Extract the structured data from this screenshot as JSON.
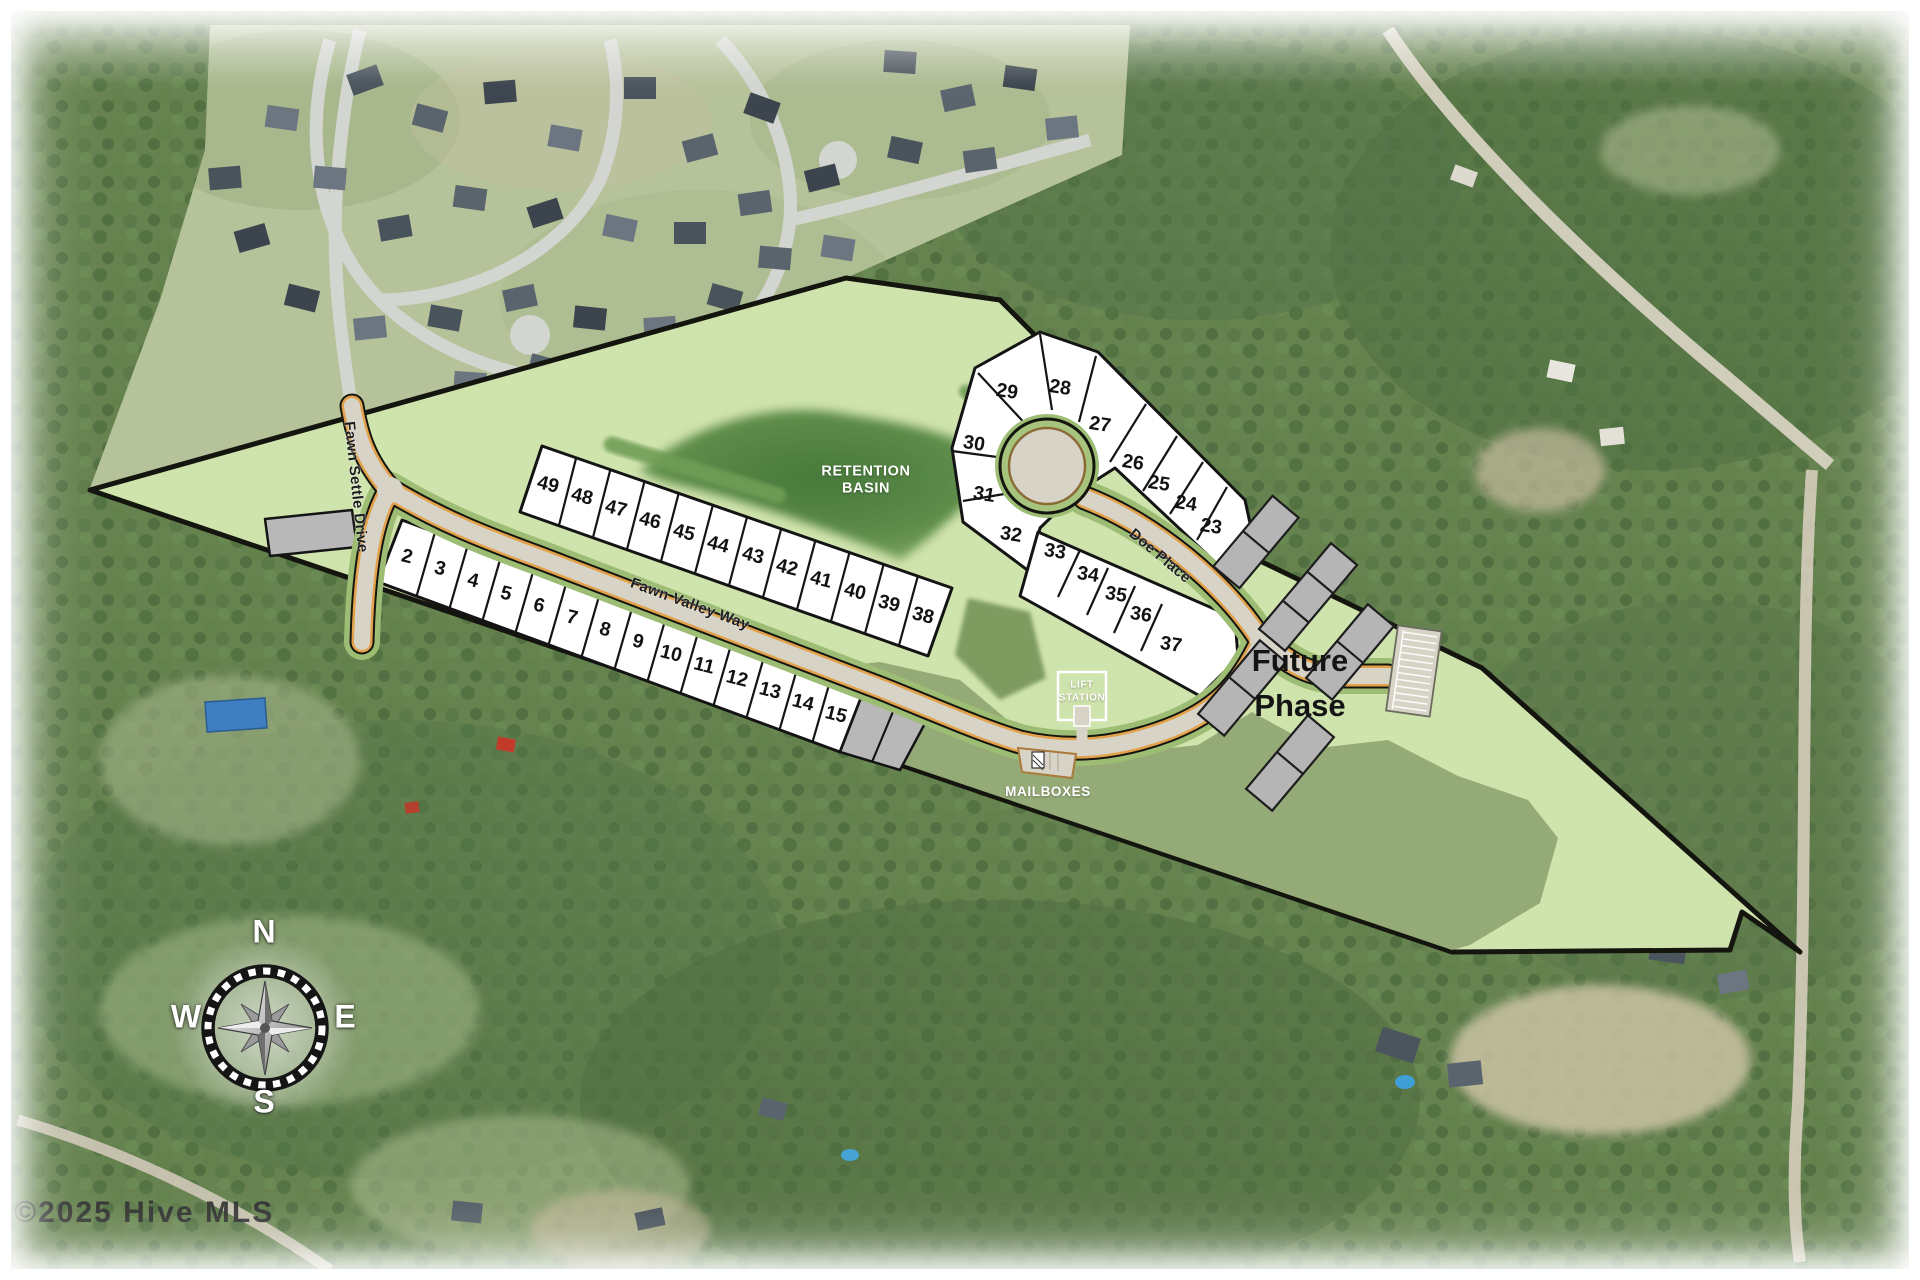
{
  "map": {
    "streets": {
      "fawn_settle": "Fawn Settle Drive",
      "fawn_valley": "Fawn Valley Way",
      "doe": "Doe Place"
    },
    "labels": {
      "retention_line1": "RETENTION",
      "retention_line2": "BASIN",
      "lift_line1": "LIFT",
      "lift_line2": "STATION",
      "mailboxes": "MAILBOXES",
      "future_line1": "Future",
      "future_line2": "Phase"
    },
    "lots": {
      "row_top": [
        "49",
        "48",
        "47",
        "46",
        "45",
        "44",
        "43",
        "42",
        "41",
        "40",
        "39",
        "38"
      ],
      "row_bottom": [
        "2",
        "3",
        "4",
        "5",
        "6",
        "7",
        "8",
        "9",
        "10",
        "11",
        "12",
        "13",
        "14",
        "15"
      ],
      "culdesac_north": [
        "29",
        "28",
        "27",
        "26",
        "25",
        "24",
        "23",
        "30",
        "31",
        "32"
      ],
      "culdesac_south": [
        "33",
        "34",
        "35",
        "36",
        "37"
      ]
    },
    "compass": {
      "n": "N",
      "e": "E",
      "s": "S",
      "w": "W"
    },
    "watermark": "©2025 Hive MLS",
    "colors": {
      "site_green": "#cfe3ad",
      "preserve_green": "#95ab77",
      "basin_green": "#4f8340",
      "road_gray": "#d8d3c7",
      "road_edge_orange": "#e2a24b",
      "lot_white": "#ffffff"
    }
  }
}
